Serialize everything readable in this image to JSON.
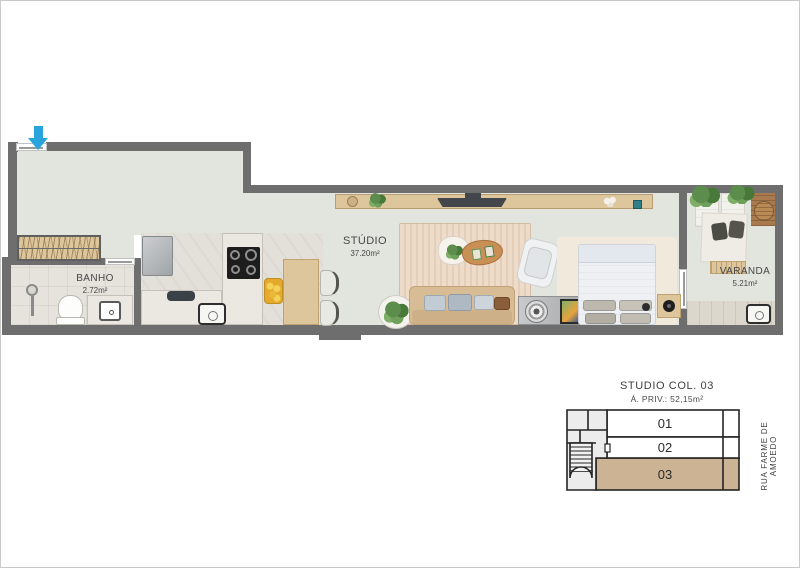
{
  "colors": {
    "wall": "#6e6e6e",
    "floor": "#e1e5de",
    "accent": "#2aa4dc",
    "wood": "#ddc59c",
    "highlight": "#cbb394",
    "text": "#474747"
  },
  "plan": {
    "entry_icon": "down-arrow",
    "rooms": {
      "banho": {
        "name": "BANHO",
        "area": "2.72m²"
      },
      "studio": {
        "name": "STÚDIO",
        "area": "37.20m²"
      },
      "varanda": {
        "name": "VARANDA",
        "area": "5.21m²"
      }
    }
  },
  "keyplan": {
    "title": "STUDIO COL. 03",
    "subtitle": "Á. PRIV.: 52,15m²",
    "units": [
      {
        "label": "01",
        "highlighted": false
      },
      {
        "label": "02",
        "highlighted": false
      },
      {
        "label": "03",
        "highlighted": true
      }
    ],
    "street_label": "RUA FARME DE AMOEDO"
  }
}
